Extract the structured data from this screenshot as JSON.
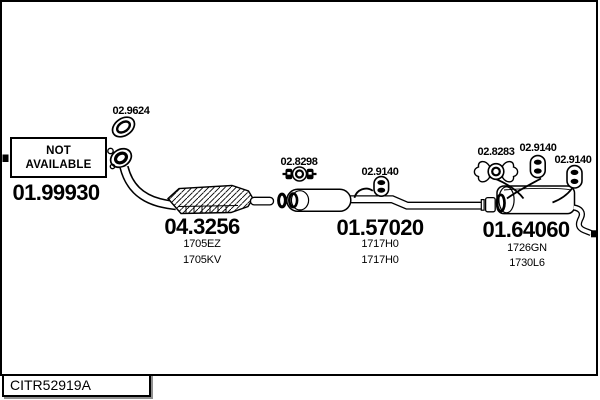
{
  "frame": {
    "code": "CITR52919A"
  },
  "not_available_box": {
    "line1": "NOT",
    "line2": "AVAILABLE"
  },
  "parts": {
    "front_pipe": {
      "number": "01.99930"
    },
    "catalyst": {
      "number": "04.3256",
      "variants": [
        "1705EZ",
        "1705KV"
      ]
    },
    "centre_silencer": {
      "number": "01.57020",
      "variants": [
        "1717H0",
        "1717H0"
      ]
    },
    "rear_silencer": {
      "number": "01.64060",
      "variants": [
        "1726GN",
        "1730L6"
      ]
    }
  },
  "fittings": {
    "gasket": {
      "number": "02.9624"
    },
    "clamp_front": {
      "number": "02.8298"
    },
    "hanger_centre": {
      "number": "02.9140"
    },
    "clamp_rear": {
      "number": "02.8283"
    },
    "hanger_rear_front": {
      "number": "02.9140"
    },
    "hanger_rear_back": {
      "number": "02.9140"
    }
  },
  "colors": {
    "line": "#000000",
    "background": "#ffffff",
    "shadow": "#8f8f8f"
  }
}
